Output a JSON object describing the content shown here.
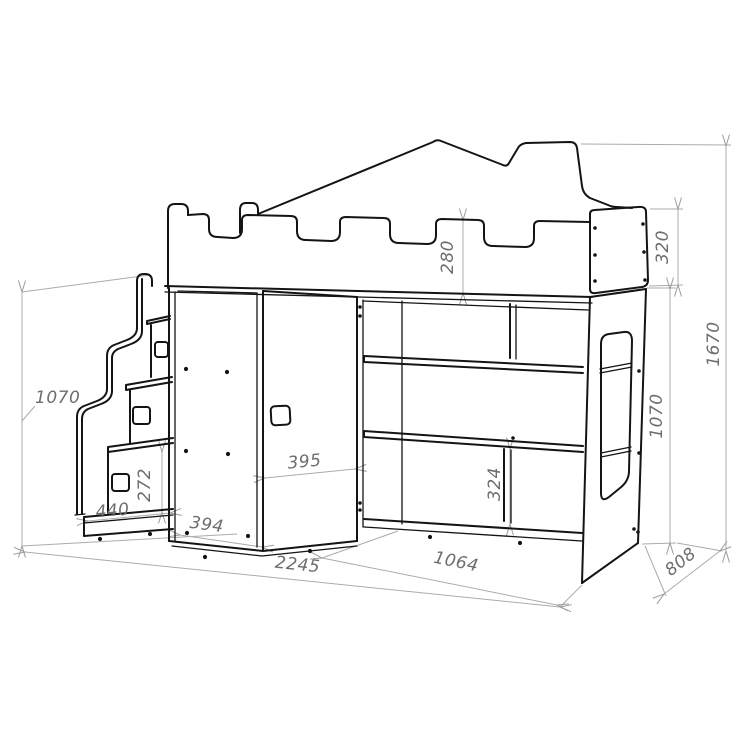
{
  "meta": {
    "type": "furniture technical drawing",
    "subject": "children loft bed with castle rail, stairs, wardrobe and shelf unit"
  },
  "colors": {
    "outline": "#141414",
    "dimension_lines": "#ababab",
    "dimension_text": "#6b6d6f",
    "background": "#ffffff"
  },
  "dimensions": {
    "guard_rail_height": "280",
    "bed_box_height": "320",
    "total_height": "1670",
    "stairs_height": "1070",
    "under_bed_height": "1070",
    "step_rise": "272",
    "step_width": "440",
    "wardrobe_door_width": "394",
    "corner_door_width": "395",
    "shelf_opening_height": "324",
    "shelf_unit_width": "1064",
    "total_width": "2245",
    "total_depth": "808"
  }
}
